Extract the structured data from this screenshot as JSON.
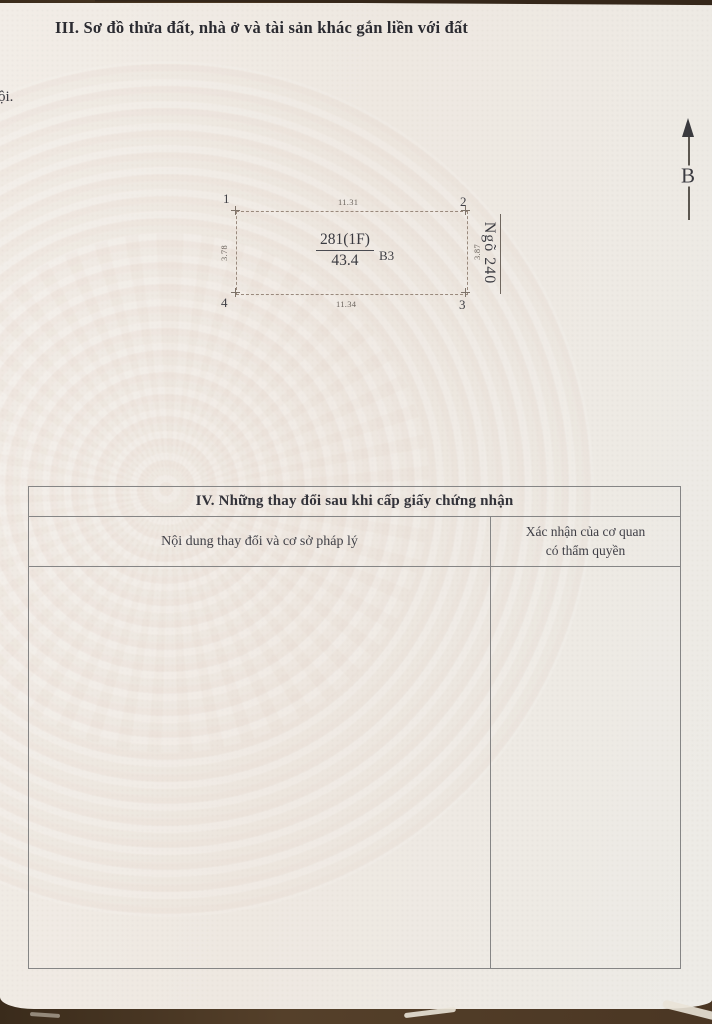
{
  "document": {
    "margin_fragment": "ội.",
    "section_iii": {
      "title": "III. Sơ đồ thửa đất, nhà ở và tài sản khác gắn liền với đất"
    },
    "north_arrow_label": "B",
    "parcel_diagram": {
      "corner_1": "1",
      "corner_2": "2",
      "corner_3": "3",
      "corner_4": "4",
      "edge_top": "11.31",
      "edge_bottom": "11.34",
      "edge_left": "3.78",
      "edge_right": "3.87",
      "parcel_code": "281(1F)",
      "parcel_area": "43.4",
      "building_label": "B3",
      "road_name": "Ngõ 240"
    },
    "section_iv": {
      "title": "IV. Những thay đổi sau khi cấp giấy chứng nhận",
      "col_left_header": "Nội dung thay đổi và cơ sở pháp lý",
      "col_right_header_line1": "Xác nhận của cơ quan",
      "col_right_header_line2": "có thẩm quyền"
    },
    "colors": {
      "paper": "#efeae3",
      "desk": "#4a3826",
      "ink": "#2e2e34",
      "table_border": "#858585",
      "diagram_dash": "#99897c",
      "watermark_pink": "#d7b6aa"
    }
  }
}
